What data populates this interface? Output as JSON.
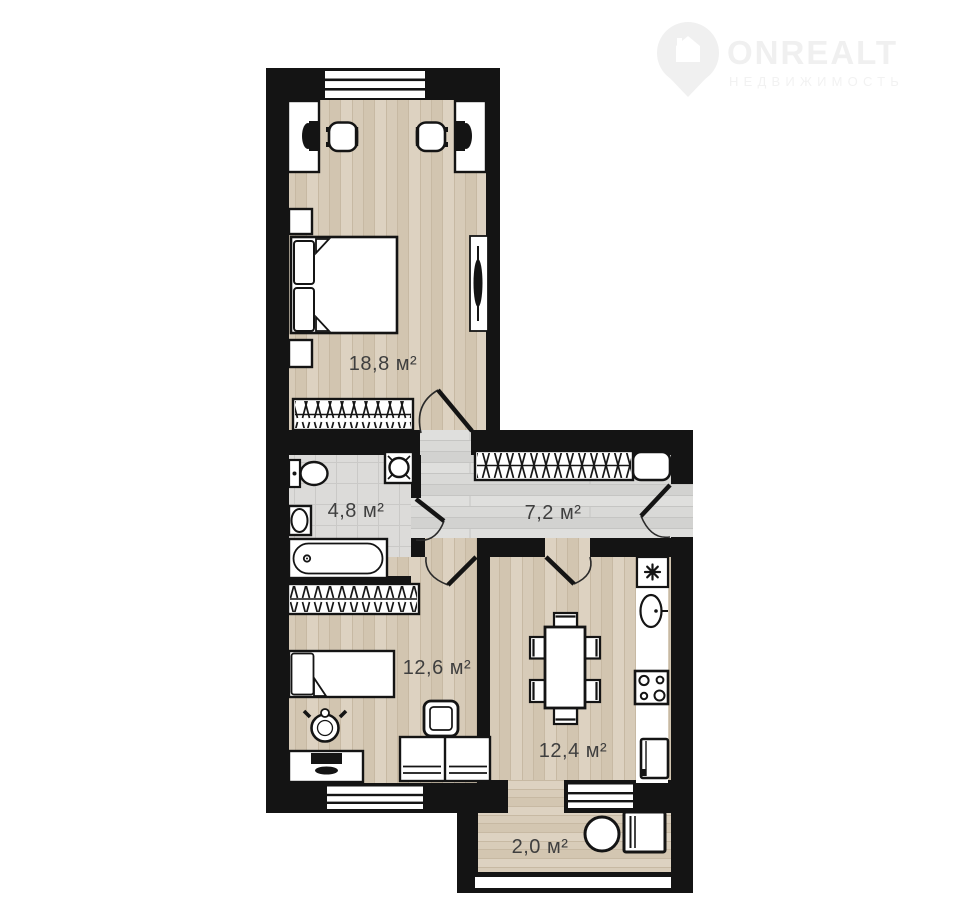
{
  "watermark": {
    "brand": "ONREALT",
    "tagline": "НЕДВИЖИМОСТЬ",
    "icon": "house-pin-icon",
    "color": "#f0f0f0"
  },
  "floorplan": {
    "rooms": [
      {
        "name": "bedroom",
        "area": "18,8 м²"
      },
      {
        "name": "bathroom",
        "area": "4,8 м²"
      },
      {
        "name": "hallway",
        "area": "7,2 м²"
      },
      {
        "name": "bedroom-2",
        "area": "12,6 м²"
      },
      {
        "name": "kitchen",
        "area": "12,4 м²"
      },
      {
        "name": "balcony",
        "area": "2,0 м²"
      }
    ],
    "colors": {
      "wall": "#141414",
      "wood_floor": "#d7cbb8",
      "gray_floor": "#d9d9d7",
      "tile_floor": "#dcdbd9",
      "label_text": "#3f3f3f"
    }
  }
}
